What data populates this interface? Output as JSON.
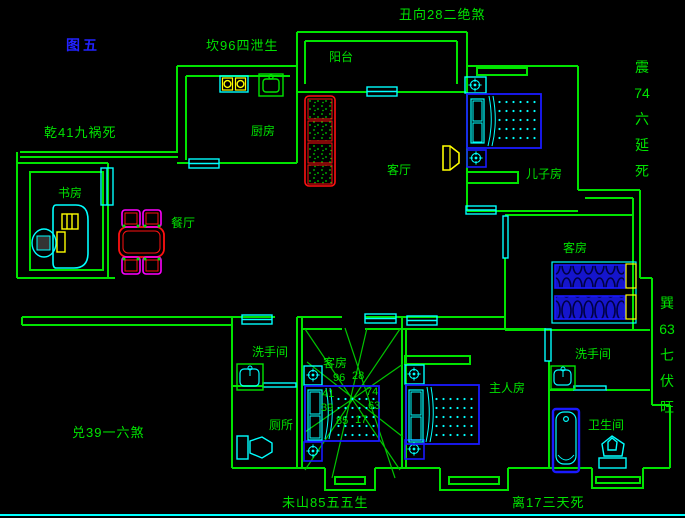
{
  "figure_label": "图五",
  "compass_texts": {
    "top_left": "坎96四泄生",
    "top_right": "丑向28二绝煞",
    "left_upper": "乾41九祸死",
    "left_lower": "兑39一六煞",
    "bottom_left": "未山85五五生",
    "bottom_right": "离17三天死",
    "right_upper": [
      "震",
      "74",
      "六",
      "延",
      "死"
    ],
    "right_lower": [
      "巽",
      "63",
      "七",
      "伏",
      "旺"
    ]
  },
  "room_labels": {
    "balcony": "阳台",
    "kitchen": "厨房",
    "living_room": "客厅",
    "son_room": "儿子房",
    "study": "书房",
    "dining": "餐厅",
    "guest_room_right": "客房",
    "guest_room_center": "客房",
    "washroom_left": "洗手间",
    "toilet": "厕所",
    "master_room": "主人房",
    "washroom_right": "洗手间",
    "bathroom": "卫生间"
  },
  "compass_numbers": {
    "top_left": "96",
    "top_right": "28",
    "mid_left": "41",
    "mid_right": "74",
    "low_left": "39",
    "low_right": "63",
    "bottom_left": "85",
    "bottom_right": "17"
  },
  "colors": {
    "background": "#000000",
    "wall_green": "#00e400",
    "cyan": "#00ffff",
    "furniture_blue": "#1a1aff",
    "red": "#ff1111",
    "yellow": "#ffff00",
    "magenta": "#ff00ff",
    "figure_blue": "#2222ff"
  }
}
